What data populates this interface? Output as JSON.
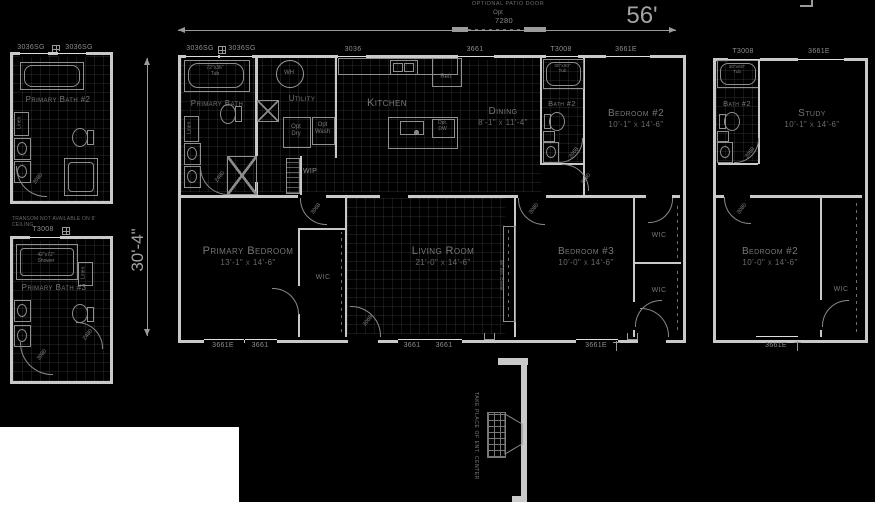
{
  "plan": {
    "width_label": "56'",
    "depth_label": "30'-4\""
  },
  "patio": {
    "title": "OPTIONAL PATIO DOOR",
    "opt": "Opt",
    "model": "7280"
  },
  "windows": {
    "w3036sg": "3036SG",
    "w3036": "3036",
    "w3661": "3661",
    "wt3008": "T3008",
    "w3661e": "3661E"
  },
  "rooms": {
    "primary_bath": "Primary Bath",
    "utility": "Utility",
    "kitchen": "Kitchen",
    "dining": "Dining",
    "dining_dims": "8'-1\" x 11'-4\"",
    "bath2": "Bath #2",
    "bedroom2": "Bedroom #2",
    "bedroom2_dims": "10'-1\" x 14'-6\"",
    "primary_bedroom": "Primary Bedroom",
    "primary_bedroom_dims": "13'-1\" x 14'-6\"",
    "living": "Living Room",
    "living_dims": "21'-0\" x 14'-6\"",
    "bedroom3": "Bedroom #3",
    "bedroom3_dims": "10'-0\" x 14'-6\"",
    "wic": "WIC",
    "wip": "WIP"
  },
  "fixtures": {
    "wh": "WH",
    "opt_dry": "Opt\nDry",
    "opt_wash": "Opt\nWash",
    "opt_dw": "Opt.\nDW",
    "refr": "Refr",
    "tub_72": "72\"x36\"\nTub",
    "tub_30": "30\"x60\"\nTub",
    "linen": "Linen",
    "shower_42": "42\"x72\"\nShower",
    "ent_center": "96\" Ent. Center"
  },
  "doors": {
    "d3080": "3080",
    "d3068": "3068",
    "d2480": "2480"
  },
  "options": {
    "left_bath2_title": "Primary Bath #2",
    "left_bath3_title": "Primary Bath #3",
    "transom_note": "TRANSOM NOT AVAILABLE ON 8' CEILING",
    "study": "Study",
    "study_dims": "10'-1\" x 14'-6\"",
    "right_bath2": "Bath #2",
    "right_bedroom2": "Bedroom #2",
    "right_bedroom2_dims": "10'-0\" x 14'-6\"",
    "fireplace_note": "TAKE PLACE OF ENT. CENTER"
  }
}
